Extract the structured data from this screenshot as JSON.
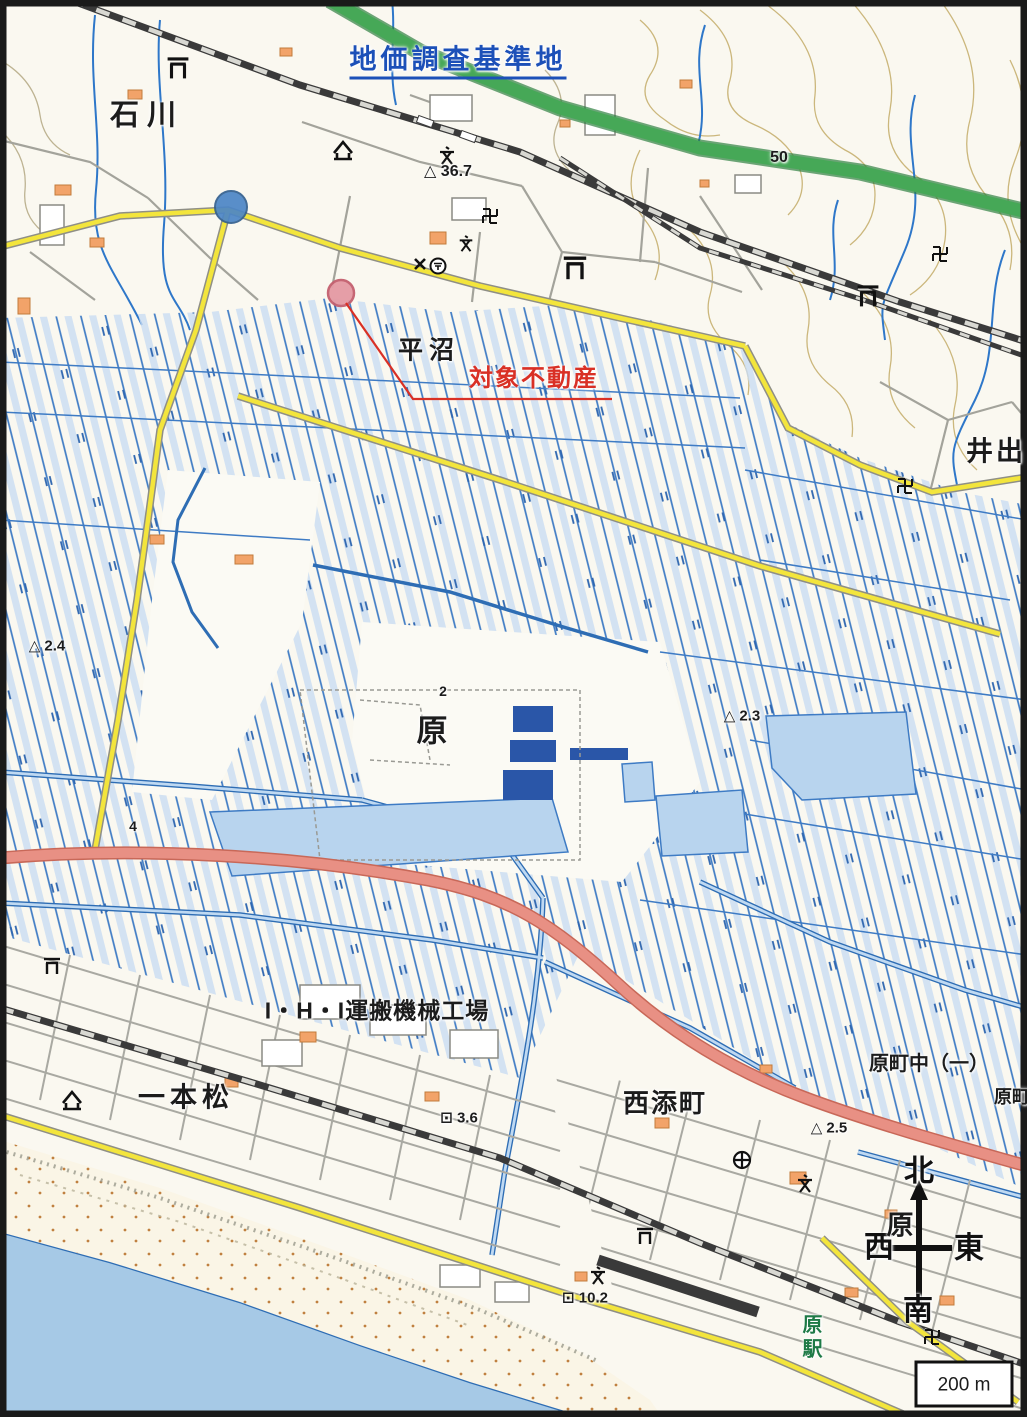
{
  "map": {
    "kind": "japanese-topographic-map",
    "labels": {
      "benchmark": "地価調査基準地",
      "subject": "対象不動産",
      "ishikawa": "石川",
      "hiranuma": "平沼",
      "ide": "井出",
      "hara": "原",
      "ipponmatsu": "一本松",
      "factory": "I・H・I運搬機械工場",
      "nishizoecho": "西添町",
      "haramachi_naka": "原町中（一）",
      "haramachi": "原町",
      "hara_station": "原駅"
    },
    "elevations": {
      "spot_36_7": "△ 36.7",
      "spot_2_4": "△ 2.4",
      "spot_2_3": "△ 2.3",
      "spot_2_5": "△ 2.5",
      "bench_3_6": "⊡ 3.6",
      "bench_10_2": "⊡ 10.2"
    },
    "contours": {
      "c50": "50",
      "c2": "2",
      "c4": "4"
    },
    "compass": {
      "north": "北",
      "south": "南",
      "east": "東",
      "west": "西",
      "area": "原"
    },
    "scale": {
      "label": "200 m"
    },
    "icons": {
      "shrine_gate": "torii-icon",
      "temple": "manji-icon",
      "school": "school-icon",
      "police_box": "police-icon",
      "post_office": "post-office-icon",
      "public_office": "health-center-icon",
      "museum": "building-icon",
      "north_arrow": "compass-arrow-icon"
    },
    "colors": {
      "annotation_blue": "#1C50B8",
      "annotation_red": "#D93025",
      "marker_blue": "#4C86C6",
      "marker_pink": "#E49AA4",
      "paddy_blue": "#3E7BC4",
      "water_fill": "#BFD9F2",
      "sea": "#A6C9E6",
      "road_yellow": "#F3E53C",
      "road_pink": "#E89084",
      "highway_green": "#46A857",
      "rail_gray": "#3A3A3A",
      "station_green": "#1E7A46"
    }
  }
}
